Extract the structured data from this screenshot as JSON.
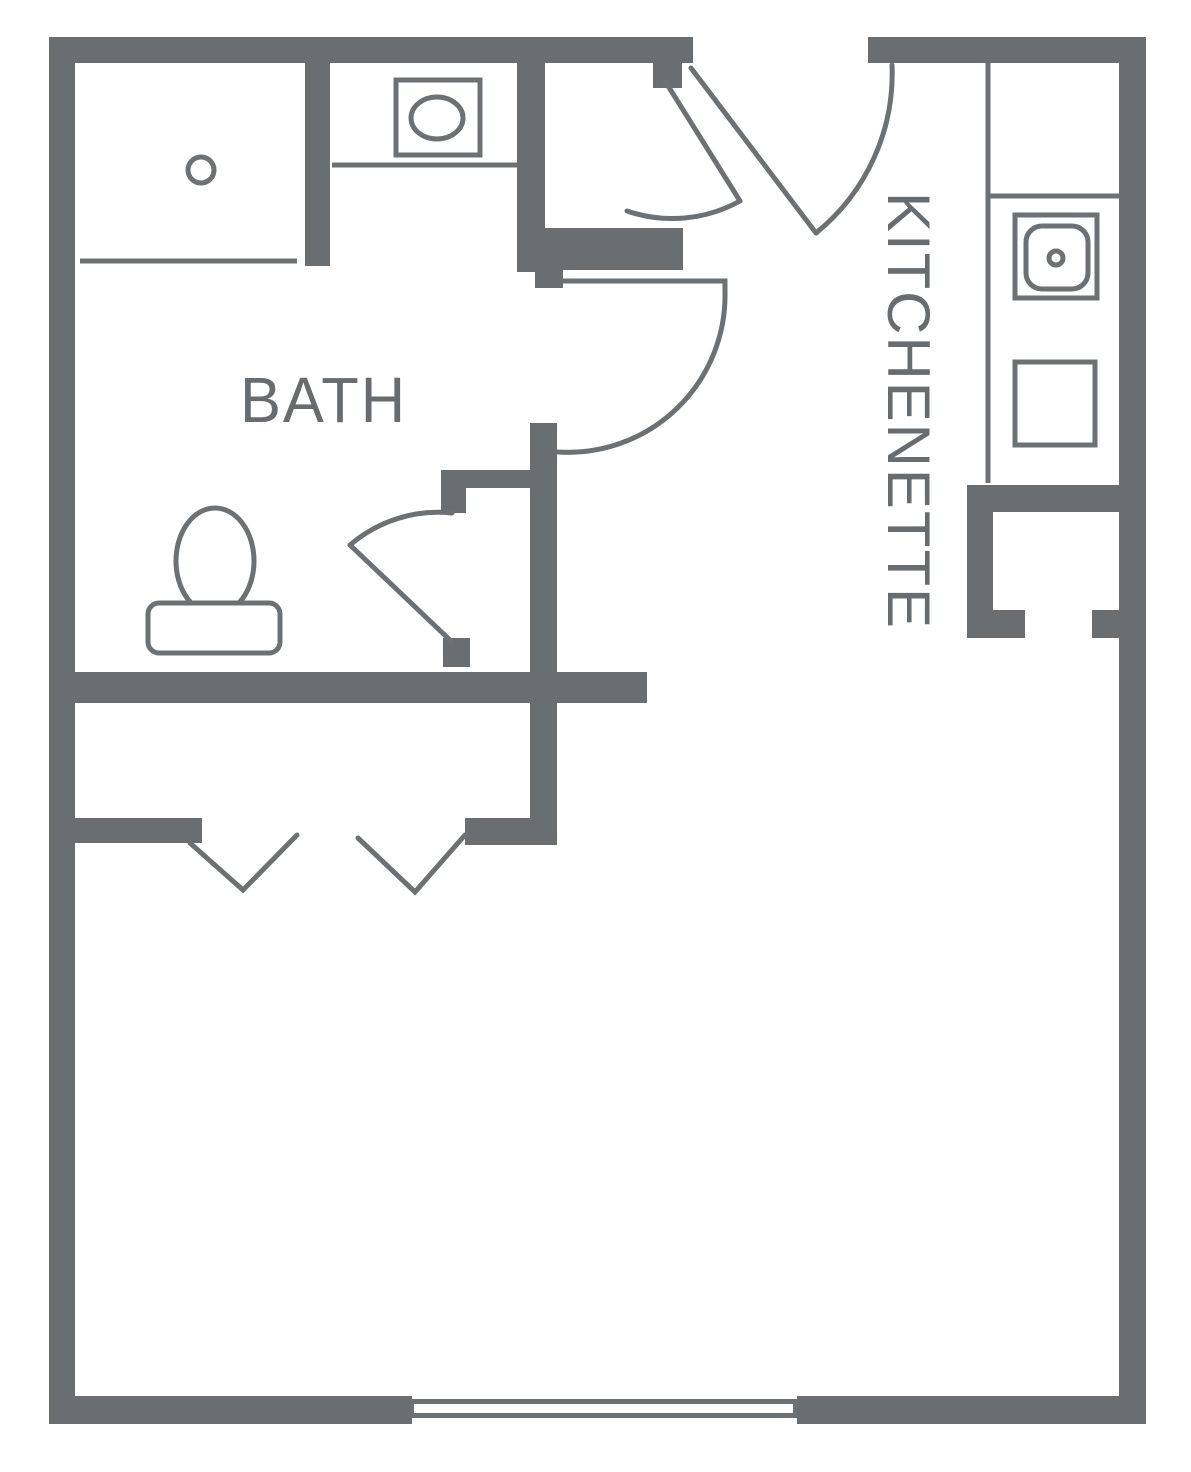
{
  "labels": {
    "bath": "BATH",
    "kitchenette": "KITCHENETTE"
  },
  "fixtures": [
    "shower-drain",
    "vanity-sink",
    "toilet",
    "kitchen-sink",
    "stove",
    "window"
  ],
  "doors": [
    "entry-door",
    "hall-closet-door",
    "bath-door",
    "bath-inner-door",
    "wardrobe-bifold-chevrons"
  ],
  "colors": {
    "wall": "#6b6e70",
    "line": "#6e7173",
    "text": "#696c6f",
    "background": "#ffffff"
  }
}
